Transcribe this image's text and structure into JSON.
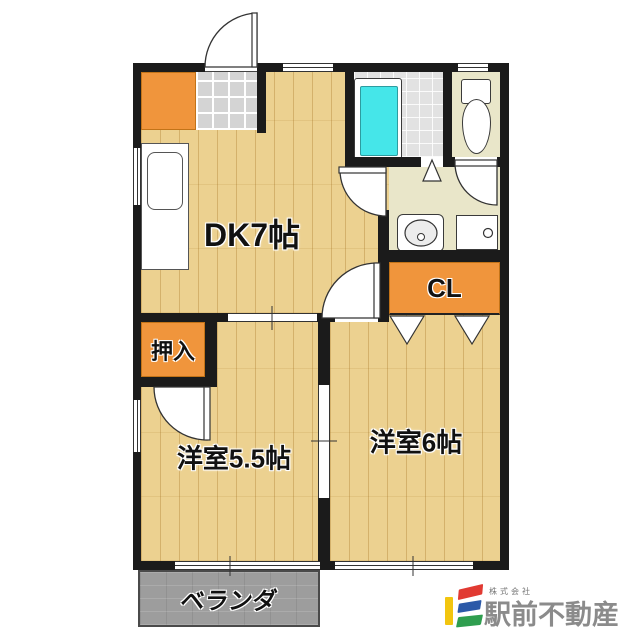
{
  "rooms": {
    "dk": {
      "label": "DK7帖"
    },
    "western_5_5": {
      "label": "洋室5.5帖"
    },
    "western_6": {
      "label": "洋室6帖"
    },
    "closet": {
      "label": "CL"
    },
    "oshiire": {
      "label": "押入"
    },
    "veranda": {
      "label": "ベランダ"
    }
  },
  "company": {
    "prefix": "株式会社",
    "name": "駅前不動産"
  },
  "colors": {
    "wall": "#1b1b1b",
    "wood_floor": "#ecd190",
    "cabinet_orange": "#f0953c",
    "tub_cyan": "#45e6e9",
    "wet_area_floor": "#e9e6c9",
    "genkan_tile_gray": "#d4d4d4",
    "veranda_gray": "#9d9d9d",
    "logo_yellow": "#f2c50f",
    "logo_red": "#e13a32",
    "logo_blue": "#2b59a8",
    "logo_green": "#2f9e4f",
    "logo_text_gray": "#8b8b8b"
  }
}
